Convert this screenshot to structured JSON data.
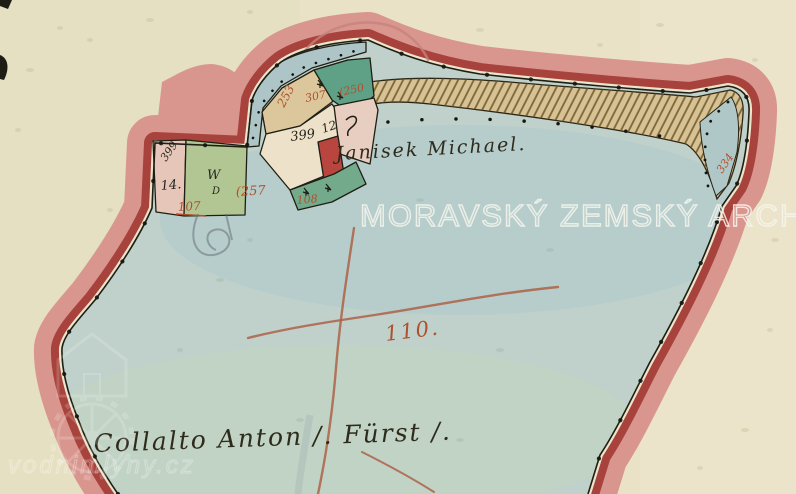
{
  "watermarks": {
    "archive": "MORAVSKÝ ZEMSKÝ ARCHIV V",
    "site": "vodnimlyny.cz"
  },
  "handwriting": {
    "strip_owner": "Janisek Michael.",
    "bottom_owner": "Collalto Anton /. Fürst /.",
    "main_parcel_number": "110."
  },
  "parcel_numbers": {
    "red_253": "253",
    "red_307": "307",
    "red_250": "(250",
    "black_399_cluster": "399",
    "black_12": "12",
    "red_108": "108",
    "black_399_left": "399",
    "black_14": "14.",
    "black_w": "W",
    "black_d": "D",
    "red_257": "(257",
    "red_107": "107",
    "red_334": "334"
  },
  "colors": {
    "paper": "#e9e2c6",
    "water_blue": "#bfd1ca",
    "band_pink": "#d9968f",
    "band_dark_red": "#a8423c",
    "strip_tan": "#d8c194",
    "parcel_green_dark": "#5fa186",
    "parcel_green_light": "#b2c694",
    "parcel_cream": "#ede2c9",
    "parcel_pink": "#e8cec1",
    "building_red": "#b8453e",
    "ink_black": "#26251c",
    "ink_red": "#b0502c"
  }
}
